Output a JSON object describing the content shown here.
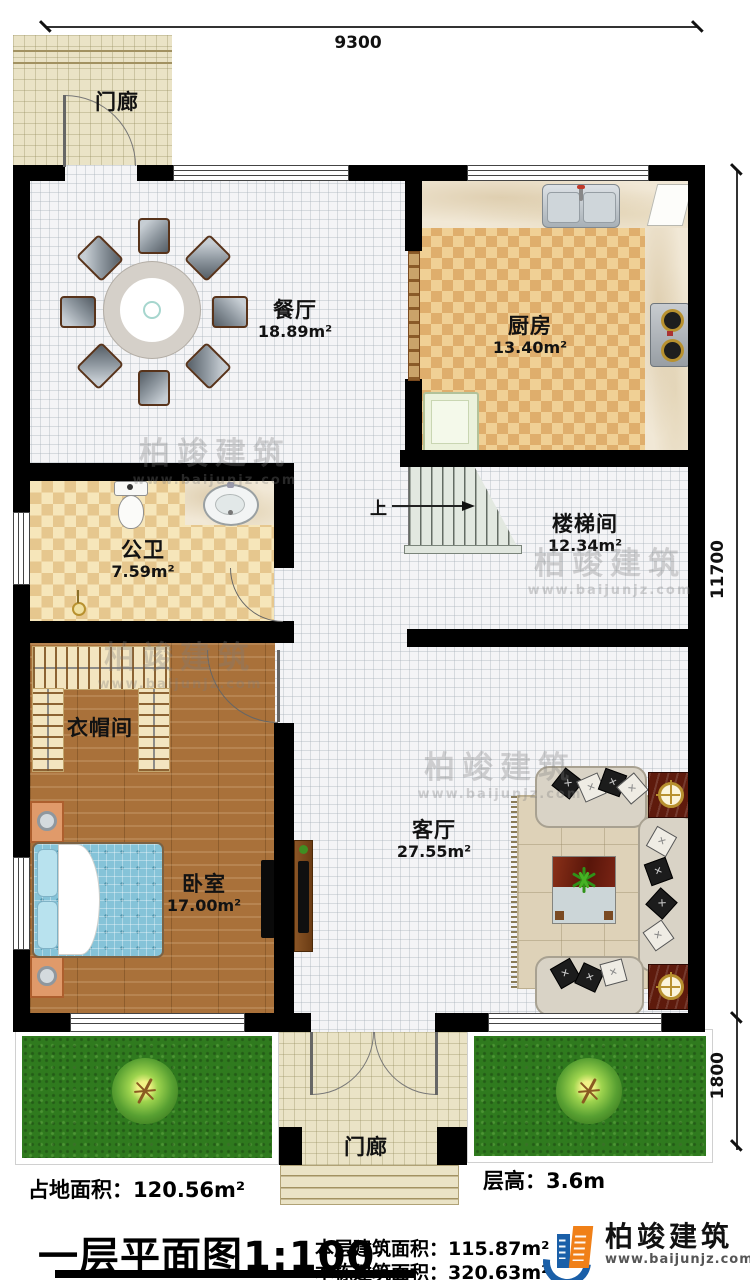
{
  "rooms": {
    "porch_top": {
      "name": "门廊"
    },
    "dining": {
      "name": "餐厅",
      "area": "18.89m²"
    },
    "kitchen": {
      "name": "厨房",
      "area": "13.40m²"
    },
    "bathroom": {
      "name": "公卫",
      "area": "7.59m²"
    },
    "stairwell": {
      "name": "楼梯间",
      "area": "12.34m²"
    },
    "cloakroom": {
      "name": "衣帽间"
    },
    "bedroom": {
      "name": "卧室",
      "area": "17.00m²"
    },
    "living": {
      "name": "客厅",
      "area": "27.55m²"
    },
    "porch_bottom": {
      "name": "门廊"
    }
  },
  "stairs": {
    "direction_label": "上"
  },
  "dimensions": {
    "top_width": "9300",
    "right_height": "11700",
    "garden_depth": "1800"
  },
  "title_block": {
    "site_area_label": "占地面积：",
    "site_area_value": "120.56m²",
    "floor_height_label": "层高：",
    "floor_height_value": "3.6m",
    "plan_title": "一层平面图1:100",
    "floor_area_label": "本层建筑面积：",
    "floor_area_value": "115.87m²",
    "building_area_label": "本栋建筑面积：",
    "building_area_value": "320.63m²"
  },
  "brand": {
    "name": "柏竣建筑",
    "website": "www.baijunjz.com"
  },
  "watermark": {
    "brand": "柏竣建筑",
    "website": "www.baijunjz.com"
  },
  "colors": {
    "wall": "#000000",
    "brand_blue": "#1a5fa8",
    "brand_orange": "#f08018",
    "garden_green": "#2f7a1e",
    "kitchen_tile": "#dfae6c",
    "accent_wood_red": "#5e1a0c"
  }
}
